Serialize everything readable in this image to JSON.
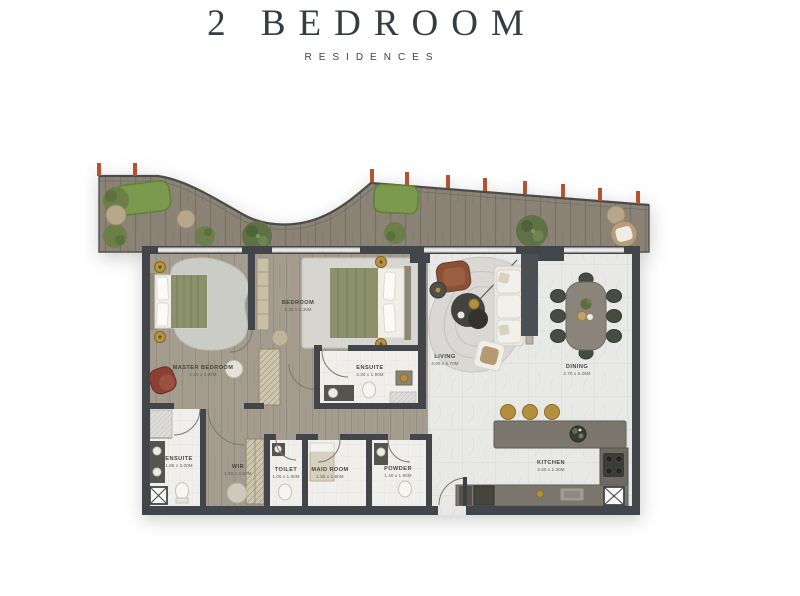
{
  "header": {
    "title": "2 Bedroom",
    "subtitle": "Residences"
  },
  "floorplan": {
    "rooms": {
      "master_bedroom": {
        "label": "MASTER BEDROOM",
        "dims": "4.20 x 3.00M"
      },
      "bedroom": {
        "label": "BEDROOM",
        "dims": "3.30 x 3.30M"
      },
      "bedroom_ensuite": {
        "label": "ENSUITE",
        "dims": "3.30 x 1.90M"
      },
      "living": {
        "label": "LIVING",
        "dims": "4.00 x 5.70M"
      },
      "dining": {
        "label": "DINING",
        "dims": "2.70 x 5.25M"
      },
      "kitchen": {
        "label": "KITCHEN",
        "dims": "4.60 x 2.30M"
      },
      "master_ensuite": {
        "label": "ENSUITE",
        "dims": "1.85 x 3.00M"
      },
      "wir": {
        "label": "WIR",
        "dims": "1.90 x 2.60M"
      },
      "toilet": {
        "label": "TOILET",
        "dims": "1.05 x 1.90M"
      },
      "maid_room": {
        "label": "MAID ROOM",
        "dims": "1.85 x 1.90M"
      },
      "powder": {
        "label": "POWDER",
        "dims": "1.40 x 1.90M"
      }
    },
    "colors": {
      "wall": "#42464b",
      "deck_wood": "#8b8376",
      "interior_wood": "#a49c8e",
      "tile": "#e8e8e6",
      "bath": "#f0efec",
      "grass": "#7c9a4e",
      "column_terracotta": "#b05530",
      "brass": "#b2903e",
      "bed_green": "#8a916b",
      "armchair_red": "#8c4034",
      "sofa_white": "#e9e7e0"
    }
  }
}
